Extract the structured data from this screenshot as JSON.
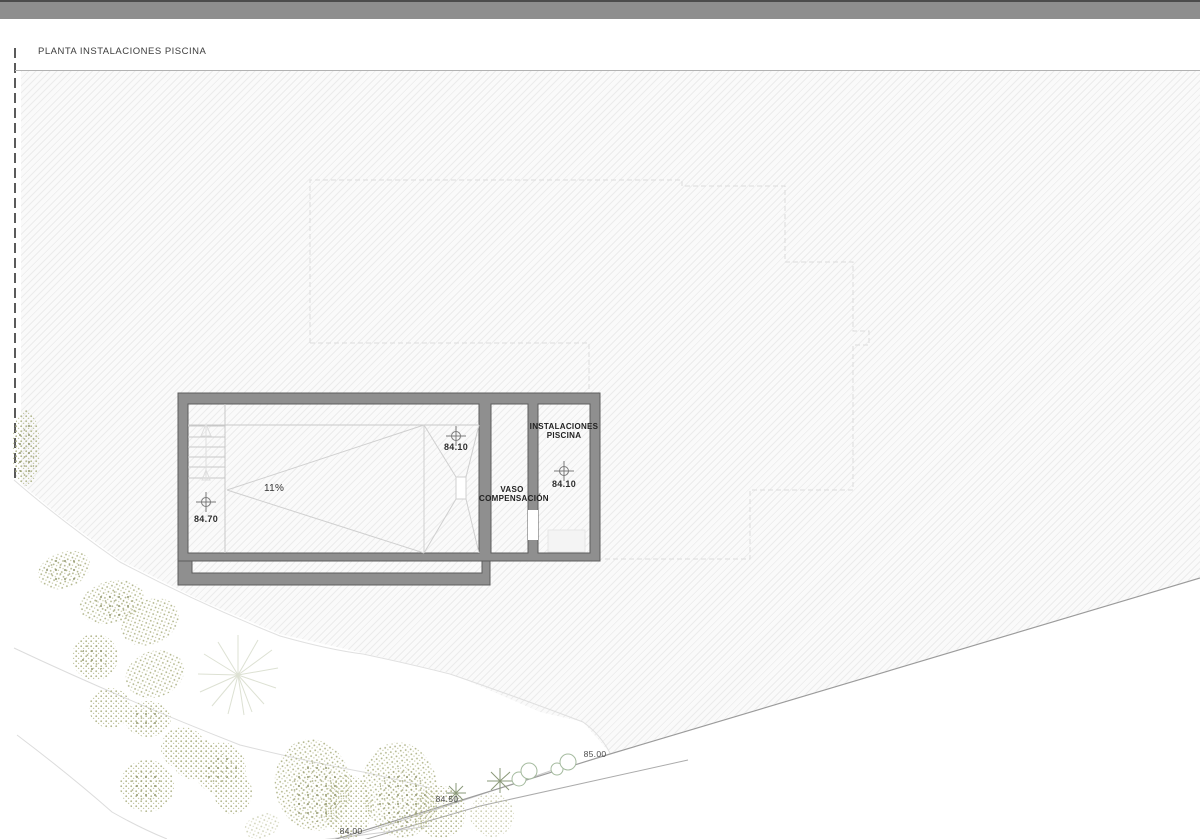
{
  "window": {
    "top_bar_color": "#8e8e8e"
  },
  "drawing": {
    "title": "PLANTA INSTALACIONES PISCINA",
    "pool": {
      "slope_label": "11%",
      "levels": {
        "shallow_end": "84.70",
        "deep_end": "84.10",
        "plant_room": "84.10"
      },
      "rooms": {
        "surge_tank": "VASO COMPENSACIÓN",
        "plant_room": "INSTALACIONES PISCINA"
      }
    },
    "site": {
      "contour_labels": [
        "85.00",
        "84.50",
        "84.00"
      ]
    },
    "colors": {
      "wall_fill": "#8f8f8f",
      "wall_edge": "#5c5c5c",
      "hatch_background": "#fafafa",
      "vegetation_stipple": "#a9ad85",
      "top_bar": "#8e8e8e"
    }
  }
}
